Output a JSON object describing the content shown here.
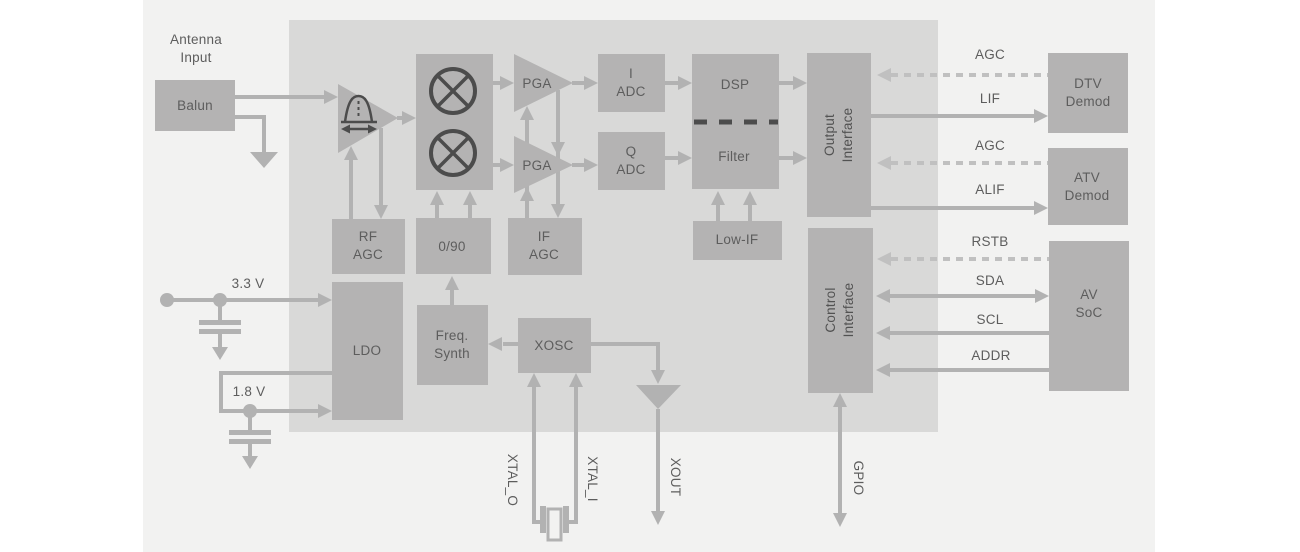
{
  "palette": {
    "page_bg": "#ffffff",
    "panel_bg": "#f2f2f1",
    "chip_bg": "#d9d9d8",
    "block_fill": "#b4b3b3",
    "wire": "#b2b2b2",
    "dashed_wire": "#c0c0c0",
    "dark_detail": "#4c4c4c",
    "label_text": "#5d5d5d"
  },
  "labels": {
    "antenna_input": "Antenna\nInput",
    "supply_3v3": "3.3 V",
    "supply_1v8": "1.8 V"
  },
  "blocks": {
    "balun": "Balun",
    "pga_i": "PGA",
    "pga_q": "PGA",
    "adc_i": "I\nADC",
    "adc_q": "Q\nADC",
    "dsp": "DSP",
    "filter": "Filter",
    "low_if": "Low-IF",
    "rf_agc": "RF\nAGC",
    "phase_0_90": "0/90",
    "if_agc": "IF\nAGC",
    "ldo": "LDO",
    "freq_synth": "Freq.\nSynth",
    "xosc": "XOSC",
    "output_interface": "Output\nInterface",
    "control_interface": "Control\nInterface",
    "dtv_demod": "DTV\nDemod",
    "atv_demod": "ATV\nDemod",
    "av_soc": "AV\nSoC"
  },
  "signals": {
    "agc_dtv": "AGC",
    "lif": "LIF",
    "agc_atv": "AGC",
    "alif": "ALIF",
    "rstb": "RSTB",
    "sda": "SDA",
    "scl": "SCL",
    "addr": "ADDR",
    "xtal_o": "XTAL_O",
    "xtal_i": "XTAL_I",
    "xout": "XOUT",
    "gpio": "GPIO"
  }
}
